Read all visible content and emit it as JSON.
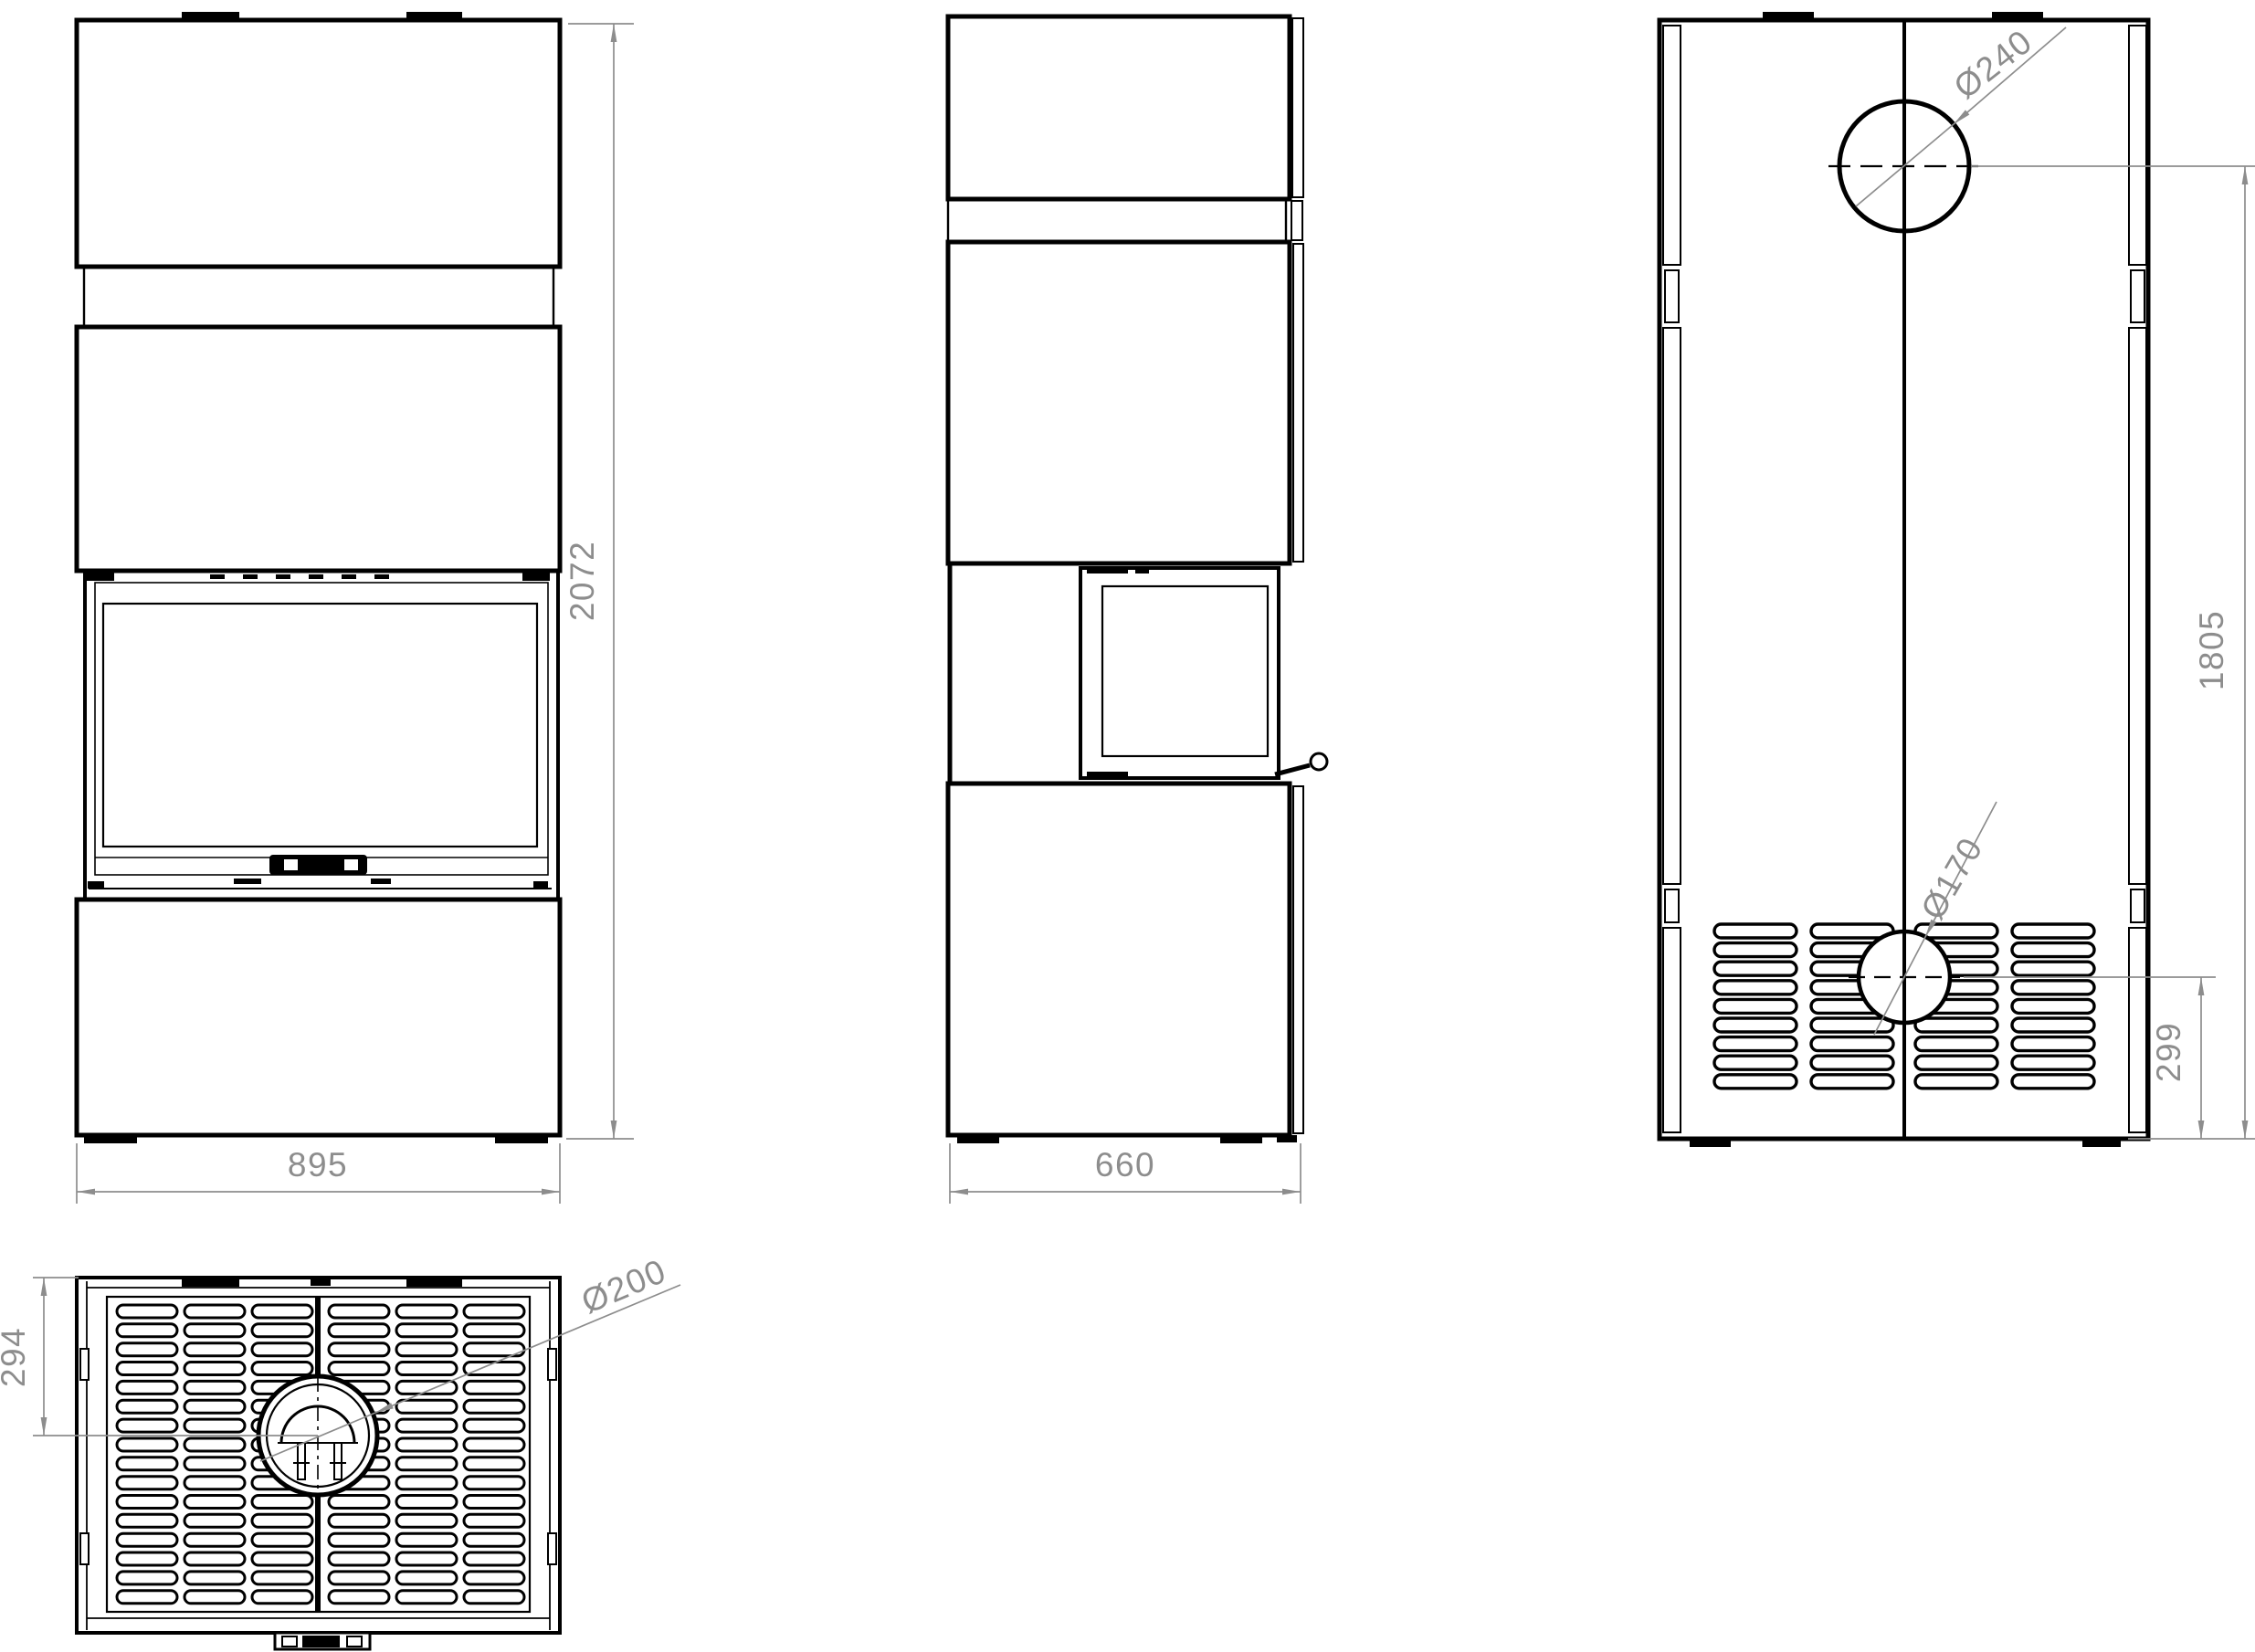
{
  "drawing": {
    "type": "technical-drawing",
    "subject": "freestanding stove - dimensioned orthographic views",
    "colors": {
      "line": "#000000",
      "dimension": "#8d8d8d",
      "background": "#ffffff"
    },
    "views": {
      "front": {
        "width_label": "895",
        "height_label": "2072"
      },
      "side": {
        "depth_label": "660"
      },
      "rear": {
        "flue_diameter_label": "Ø240",
        "flue_center_height_label": "1805",
        "intake_diameter_label": "Ø170",
        "intake_center_height_label": "299"
      },
      "top": {
        "flue_diameter_label": "Ø200",
        "flue_center_offset_label": "294"
      }
    }
  }
}
